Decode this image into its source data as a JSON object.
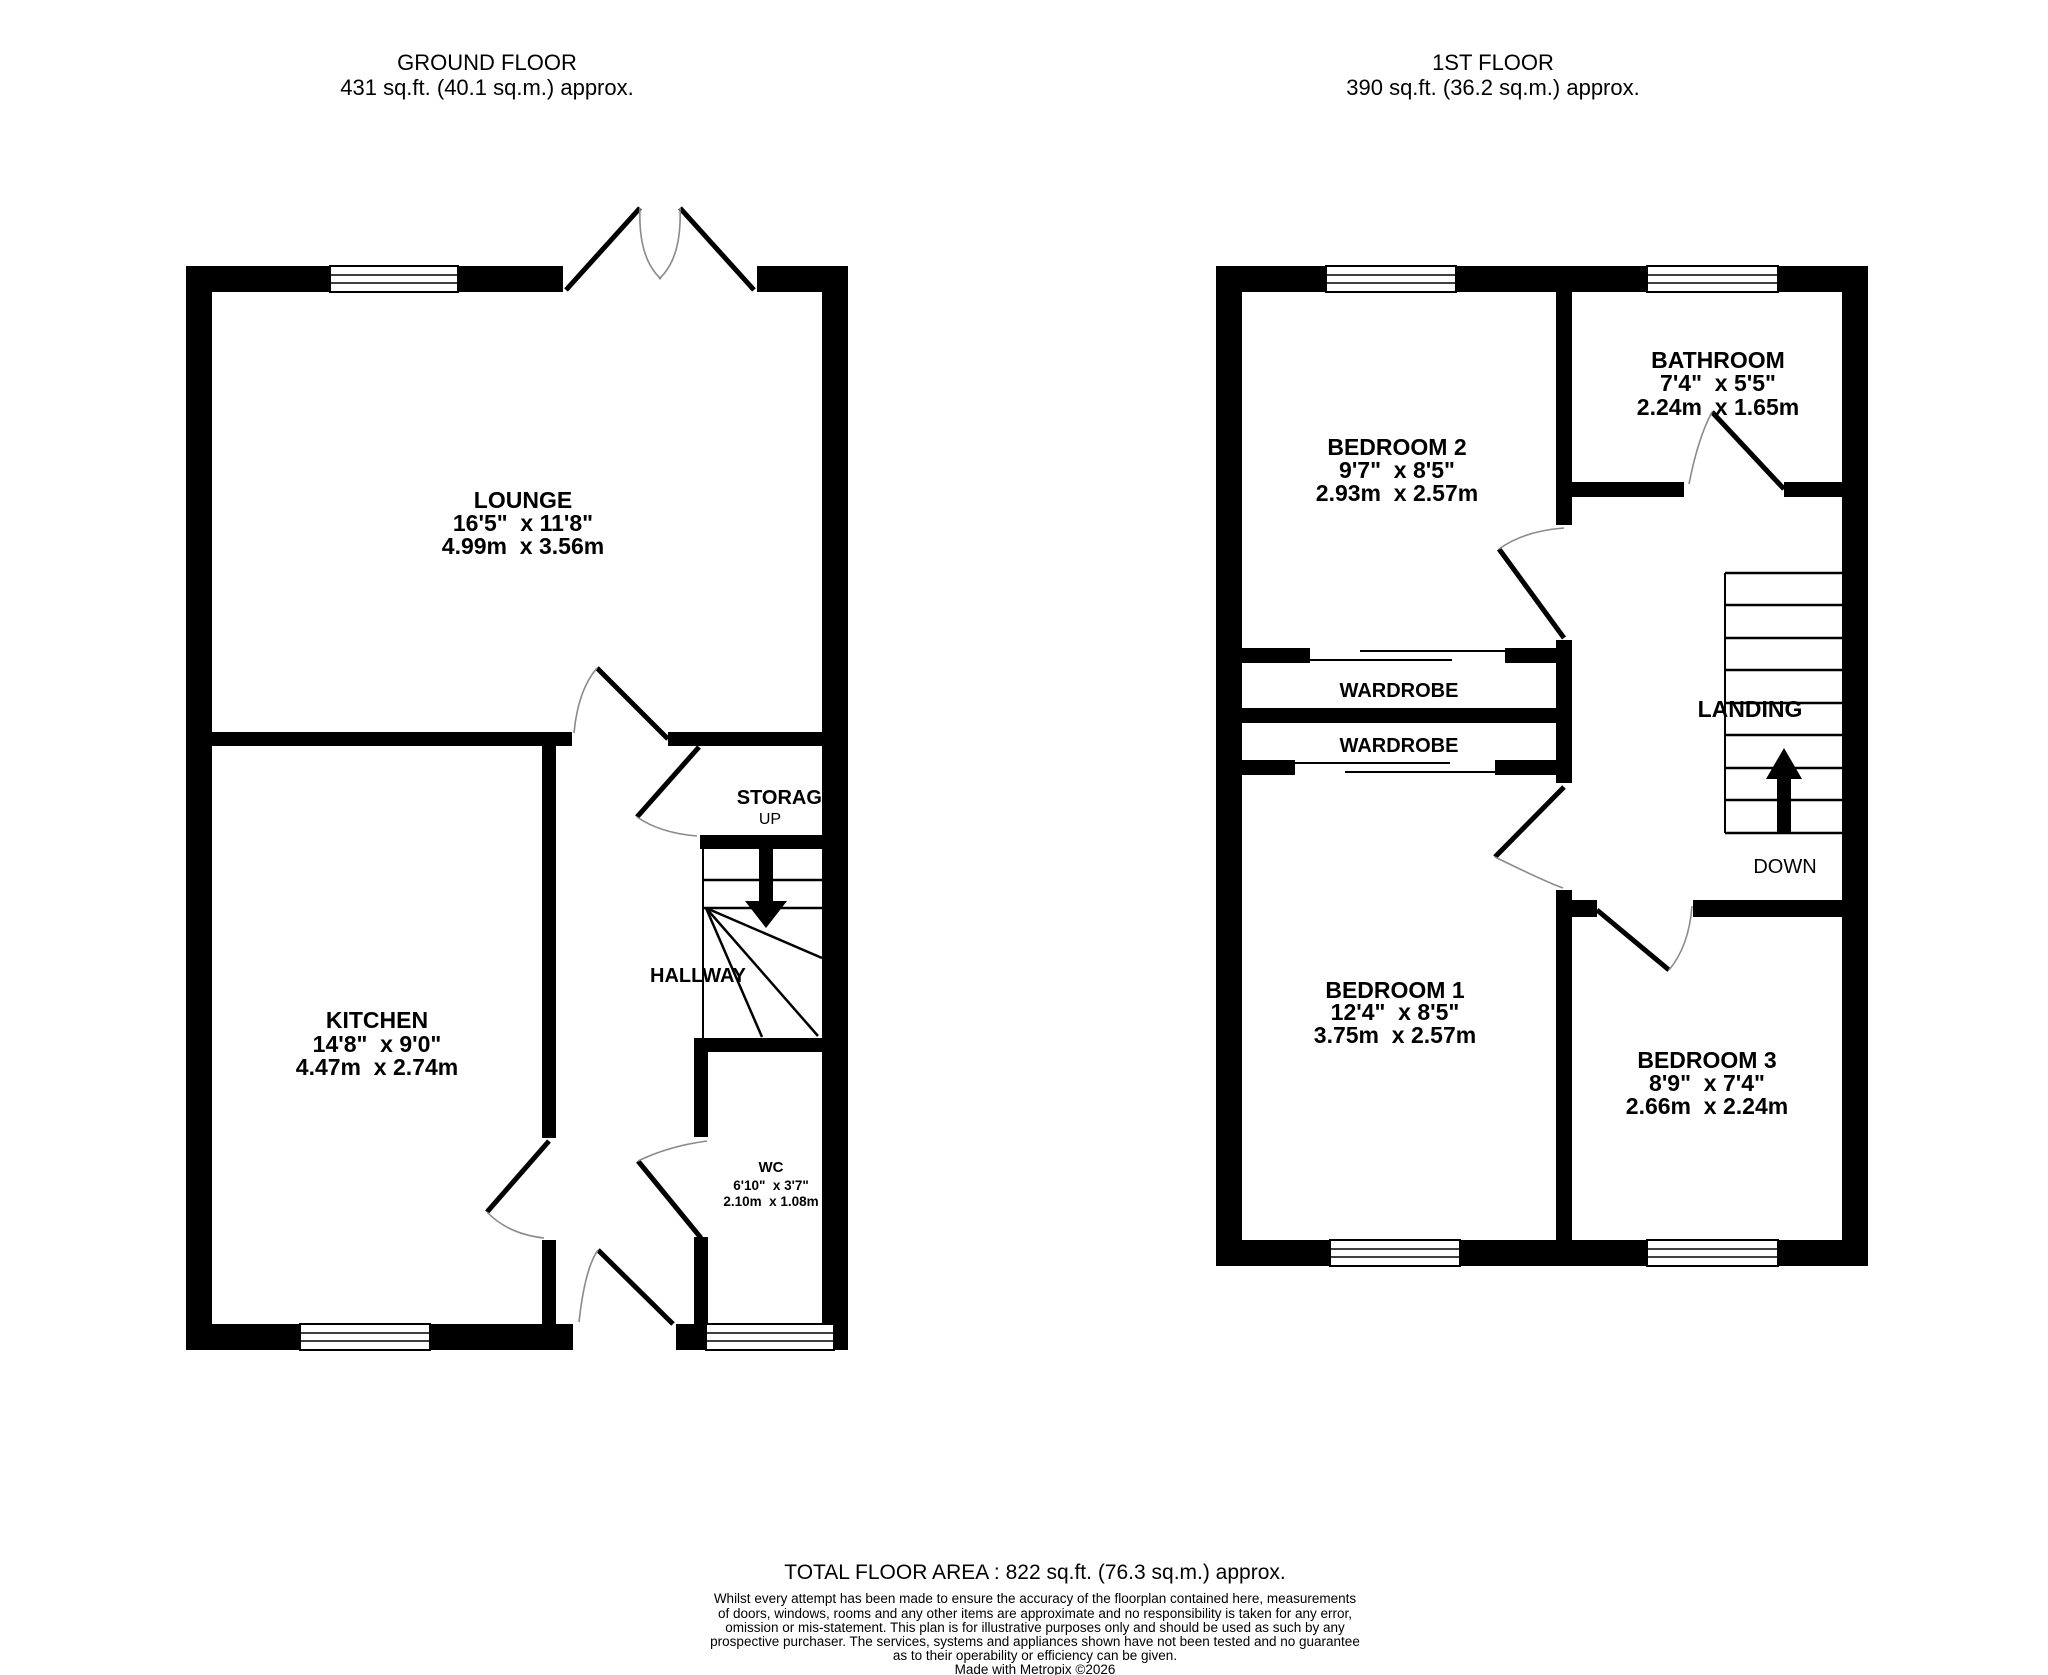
{
  "ground_floor": {
    "title": "GROUND FLOOR",
    "area": "431 sq.ft. (40.1 sq.m.) approx.",
    "rooms": {
      "lounge": {
        "name": "LOUNGE",
        "imperial": "16'5\"  x 11'8\"",
        "metric": "4.99m  x 3.56m"
      },
      "kitchen": {
        "name": "KITCHEN",
        "imperial": "14'8\"  x 9'0\"",
        "metric": "4.47m  x 2.74m"
      },
      "wc": {
        "name": "WC",
        "imperial": "6'10\"  x 3'7\"",
        "metric": "2.10m  x 1.08m"
      }
    },
    "labels": {
      "storage": "STORAGE",
      "up": "UP",
      "hallway": "HALLWAY"
    }
  },
  "first_floor": {
    "title": "1ST FLOOR",
    "area": "390 sq.ft. (36.2 sq.m.) approx.",
    "rooms": {
      "bedroom2": {
        "name": "BEDROOM 2",
        "imperial": "9'7\"  x 8'5\"",
        "metric": "2.93m  x 2.57m"
      },
      "bathroom": {
        "name": "BATHROOM",
        "imperial": "7'4\"  x 5'5\"",
        "metric": "2.24m  x 1.65m"
      },
      "bedroom1": {
        "name": "BEDROOM 1",
        "imperial": "12'4\"  x 8'5\"",
        "metric": "3.75m  x 2.57m"
      },
      "bedroom3": {
        "name": "BEDROOM 3",
        "imperial": "8'9\"  x 7'4\"",
        "metric": "2.66m  x 2.24m"
      }
    },
    "labels": {
      "wardrobe1": "WARDROBE",
      "wardrobe2": "WARDROBE",
      "landing": "LANDING",
      "down": "DOWN"
    }
  },
  "footer": {
    "total_area": "TOTAL FLOOR AREA : 822 sq.ft. (76.3 sq.m.) approx.",
    "disclaimer_lines": [
      "Whilst every attempt has been made to ensure the accuracy of the floorplan contained here, measurements",
      "of doors, windows, rooms and any other items are approximate and no responsibility is taken for any error,",
      "omission or mis-statement. This plan is for illustrative purposes only and should be used as such by any",
      "prospective purchaser. The services, systems and appliances shown have not been tested and no guarantee",
      "as to their operability or efficiency can be given."
    ],
    "credit": "Made with Metropix ©2026"
  },
  "colors": {
    "wall": "#000000",
    "background": "#ffffff",
    "door_arc": "#8a8a8a"
  }
}
